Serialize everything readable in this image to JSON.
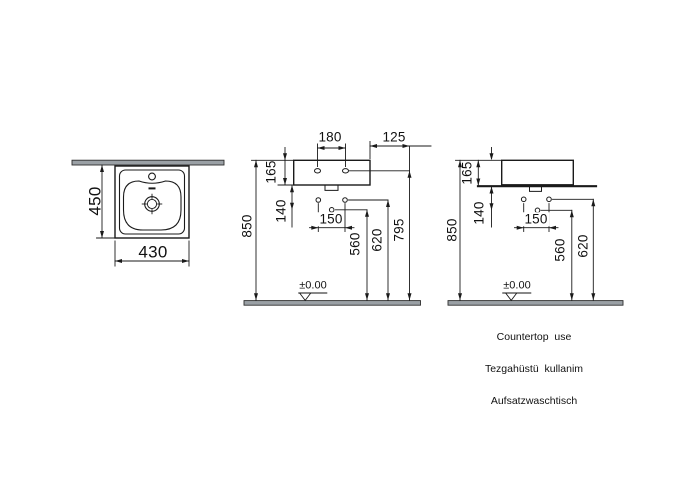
{
  "page": {
    "background": "#ffffff",
    "line_color": "#1a1a1a",
    "section_fill": "#9aa0a5"
  },
  "top_view": {
    "depth": "450",
    "width": "430"
  },
  "front_view": {
    "tap_hole_spacing": "180",
    "tap_hole_edge_offset": "125",
    "rim_to_bottom": "165",
    "bottom_to_hole": "140",
    "fixing_hole_spacing": "150",
    "drain_hole_height": "560",
    "fixing_holes_height": "620",
    "tap_hole_height": "795",
    "rim_height": "850",
    "floor_datum": "±0.00"
  },
  "countertop_view": {
    "rim_to_counter": "165",
    "counter_to_hole": "140",
    "fixing_hole_spacing": "150",
    "drain_hole_height": "560",
    "fixing_holes_height": "620",
    "rim_height": "850",
    "floor_datum": "±0.00",
    "captions": {
      "english": "Countertop  use",
      "turkish": "Tezgahüstü  kullanim",
      "german": "Aufsatzwaschtisch"
    }
  }
}
